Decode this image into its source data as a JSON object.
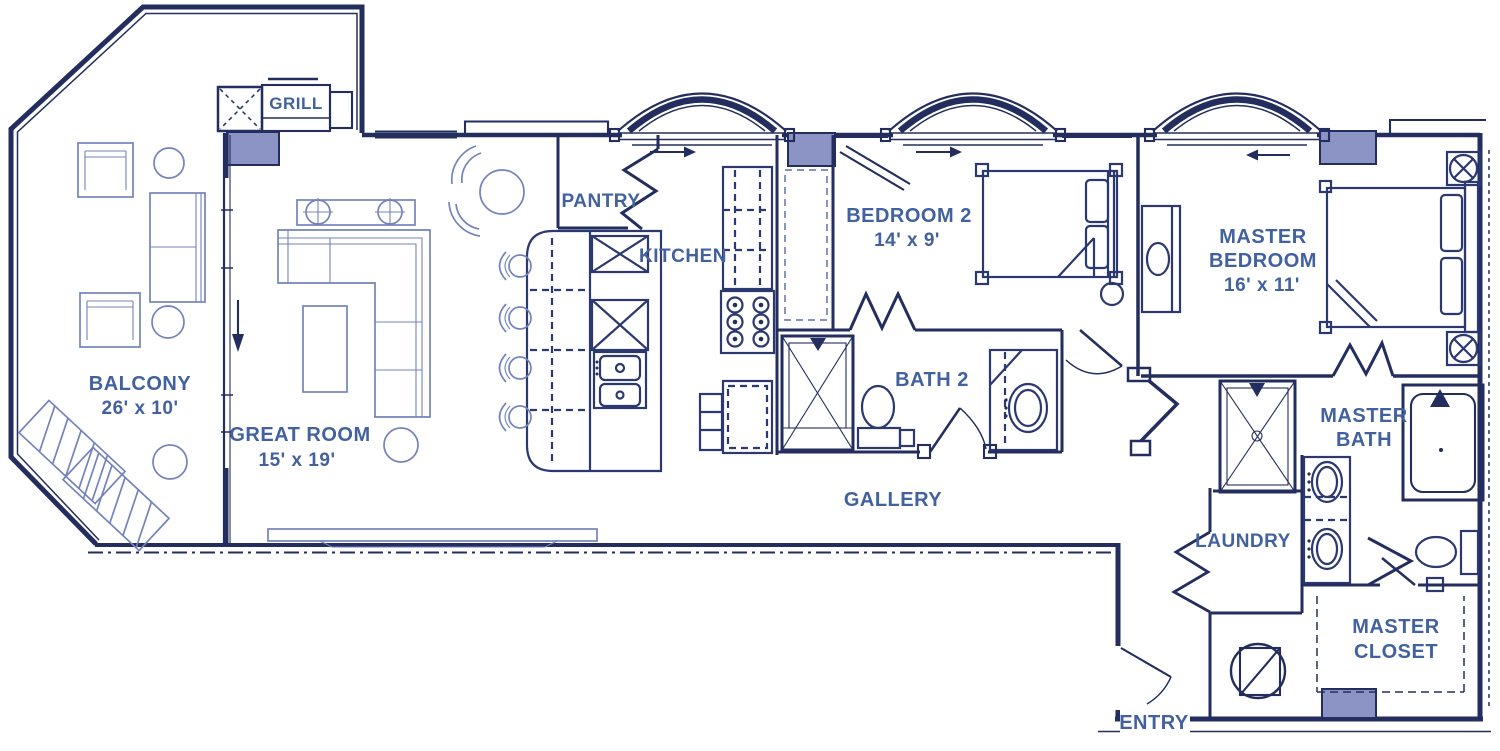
{
  "document": {
    "kind": "apartment-floor-plan",
    "style": "blueprint"
  },
  "colors": {
    "wall_line": "#232e5f",
    "structural_fill": "#8b94c5",
    "label_text": "#41619f",
    "furniture_line": "#7483bb",
    "background": "#ffffff"
  },
  "labels": {
    "grill": "GRILL",
    "balcony": {
      "name": "BALCONY",
      "dims": "26' x 10'"
    },
    "great_room": {
      "name": "GREAT ROOM",
      "dims": "15' x 19'"
    },
    "pantry": "PANTRY",
    "kitchen": "KITCHEN",
    "bedroom2": {
      "name": "BEDROOM 2",
      "dims": "14' x 9'"
    },
    "bath2": "BATH 2",
    "gallery": "GALLERY",
    "master_bedroom": {
      "line1": "MASTER",
      "line2": "BEDROOM",
      "dims": "16' x 11'"
    },
    "master_bath": {
      "line1": "MASTER",
      "line2": "BATH"
    },
    "laundry": "LAUNDRY",
    "master_closet": {
      "line1": "MASTER",
      "line2": "CLOSET"
    },
    "entry": "ENTRY"
  },
  "fixtures": {
    "arched_windows": 3,
    "ceiling_fixture_symbols": 2,
    "water_heater": 1,
    "kitchen_bar_stools": 4
  }
}
